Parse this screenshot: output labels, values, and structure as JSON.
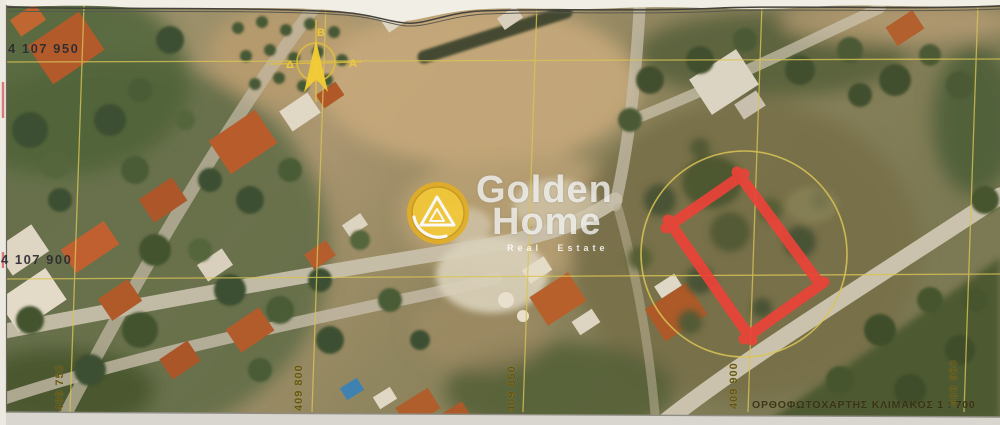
{
  "map": {
    "caption": "ΟΡΘΟΦΩΤΟΧΑΡΤΗΣ ΚΛΙΜΑΚΟΣ 1 : 700",
    "northings": [
      "4 107 950",
      "4 107 900"
    ],
    "eastings": [
      "409 750",
      "409 800",
      "409 850",
      "409 900",
      "409 950"
    ],
    "grid_color": "#d9c455",
    "highlight_rectangle_color": "#ea4338",
    "highlight_circle_color": "#d9c455"
  },
  "watermark": {
    "line1": "Golden",
    "line2": "Home",
    "tagline": "Real Estate",
    "coin_color": "#f0c435",
    "text_color": "#ffffff"
  },
  "compass": {
    "north": "Β",
    "west": "Δ",
    "east": "Α",
    "color": "#ecca3e"
  }
}
